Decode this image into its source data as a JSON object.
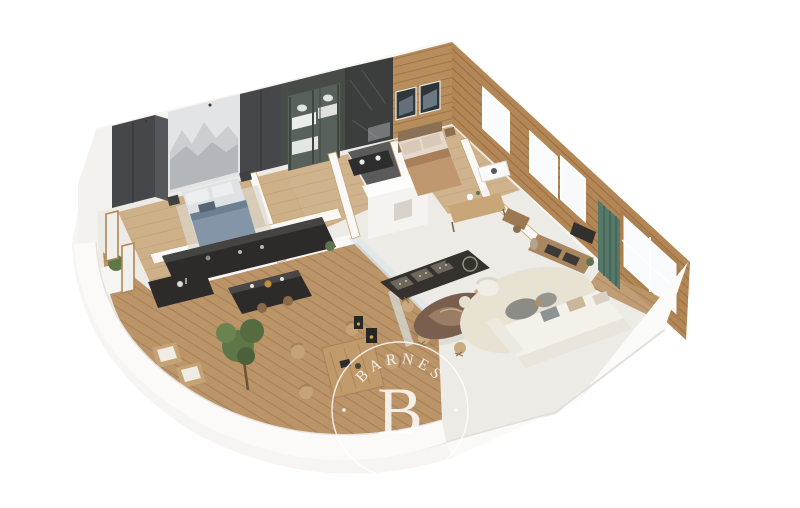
{
  "watermark": {
    "brand": "BARNES",
    "monogram": "B"
  },
  "palette": {
    "background": "#ffffff",
    "wall_white": "#f7f6f3",
    "floor_light": "#edebe6",
    "wood_wall": "#b28655",
    "wood_floor": "#c8a577",
    "deck_wood": "#bb9468",
    "joinery_dark": "#45474b",
    "kitchen_black": "#2c2b2a",
    "bunk_green": "#58615a",
    "marble_black": "#3b3e3d",
    "curtain_green": "#567869",
    "bed_blue_gray": "#8395a6",
    "bed_tan": "#c0976f",
    "sofa_cream": "#f3f1ea",
    "rug_cream": "#e8e2d3",
    "dining_brown": "#7b5f4e",
    "plant_green": "#5f7748",
    "watermark": "#ffffff"
  }
}
